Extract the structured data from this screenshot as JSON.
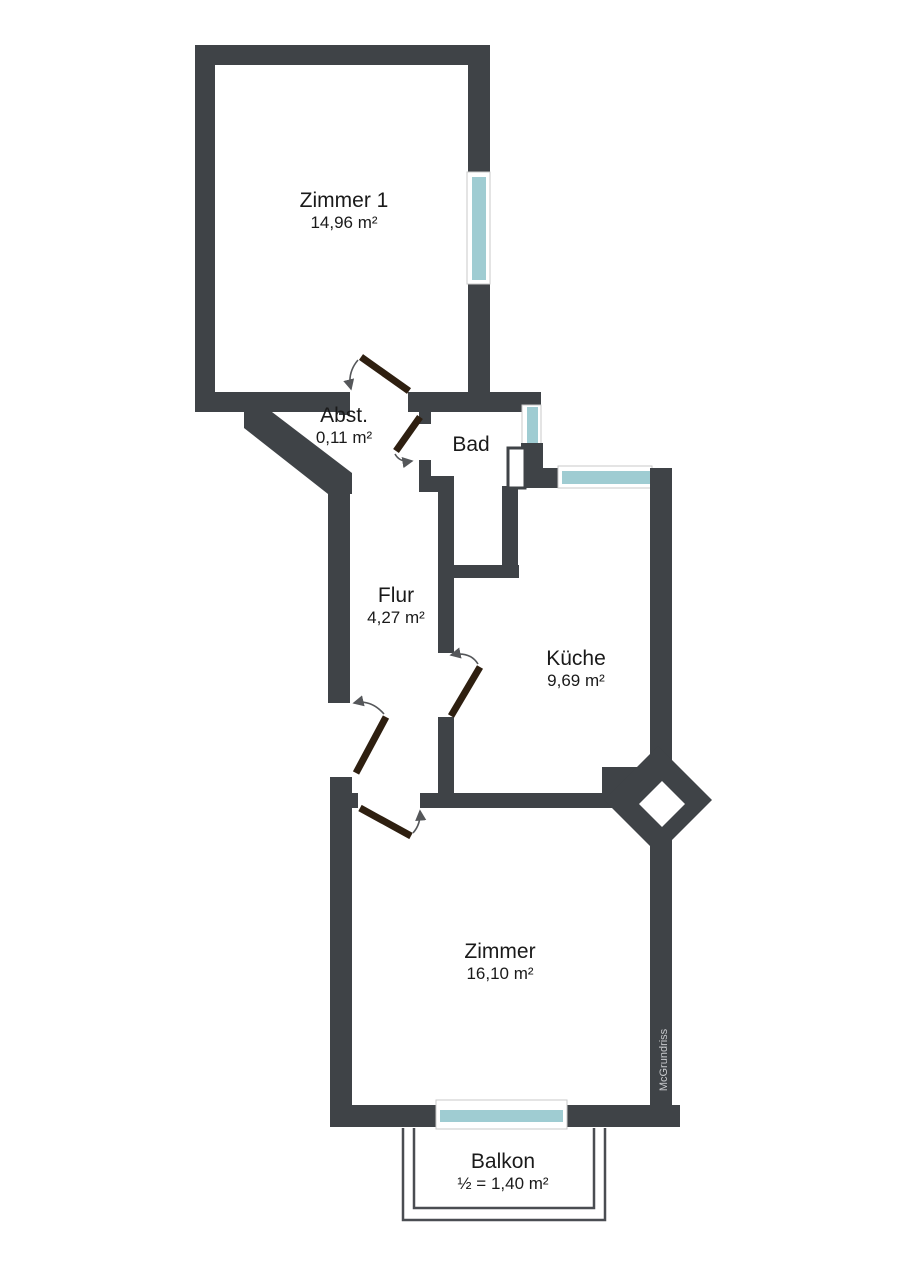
{
  "watermark": "McGrundriss",
  "colors": {
    "wall": "#3F4347",
    "door": "#2E1F10",
    "window": "#9FCCD2",
    "window-frame": "#C9C9C9",
    "arc": "#55575A",
    "balcony-line": "#4A4D52",
    "label": "#1A1A1A",
    "watermark": "#C8CACD"
  },
  "rooms": [
    {
      "id": "zimmer1",
      "name": "Zimmer 1",
      "area": "14,96 m²"
    },
    {
      "id": "abst",
      "name": "Abst.",
      "area": "0,11 m²"
    },
    {
      "id": "bad",
      "name": "Bad",
      "area": ""
    },
    {
      "id": "flur",
      "name": "Flur",
      "area": "4,27 m²"
    },
    {
      "id": "kueche",
      "name": "Küche",
      "area": "9,69 m²"
    },
    {
      "id": "zimmer",
      "name": "Zimmer",
      "area": "16,10 m²"
    },
    {
      "id": "balkon",
      "name": "Balkon",
      "area": "½ = 1,40 m²"
    }
  ]
}
